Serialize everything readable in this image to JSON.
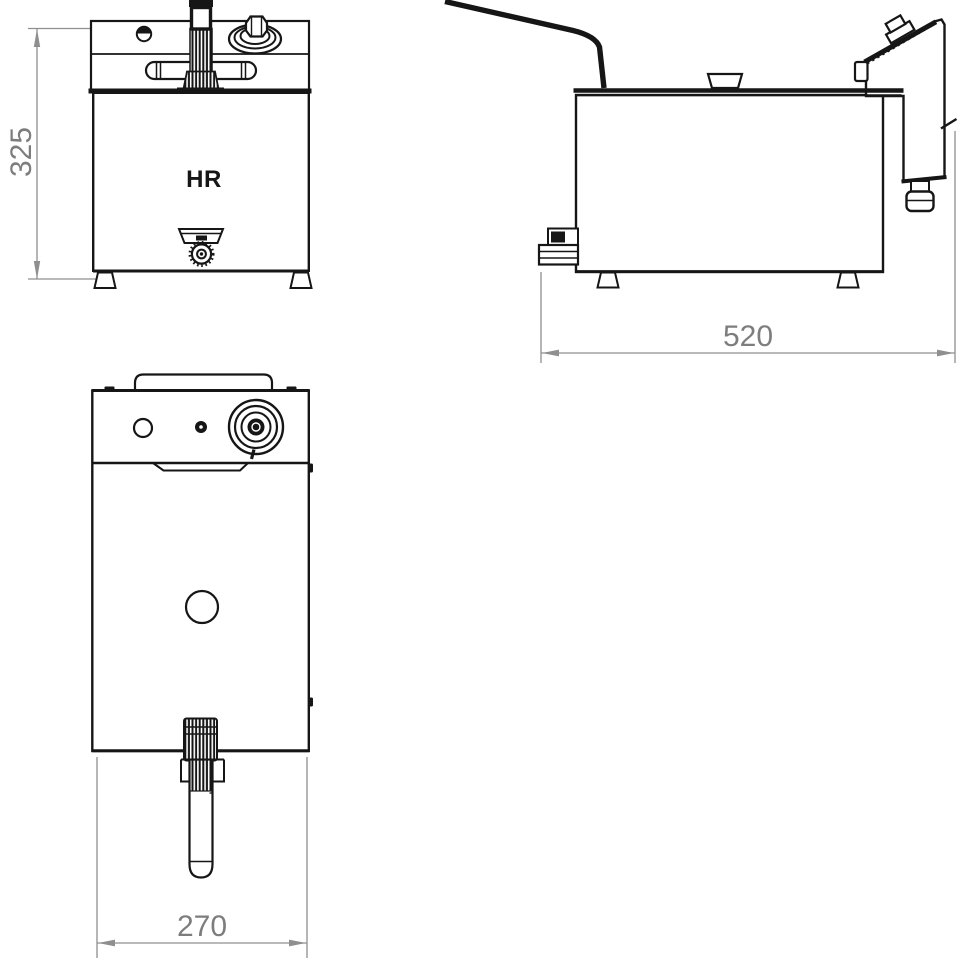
{
  "drawing": {
    "brand_label": "HR",
    "dimensions": {
      "height_mm": "325",
      "depth_mm": "520",
      "width_mm": "270"
    },
    "colors": {
      "line": "#161616",
      "dimension_line": "#8f8f8f",
      "dimension_text": "#7d7d7d",
      "background": "#ffffff"
    }
  }
}
